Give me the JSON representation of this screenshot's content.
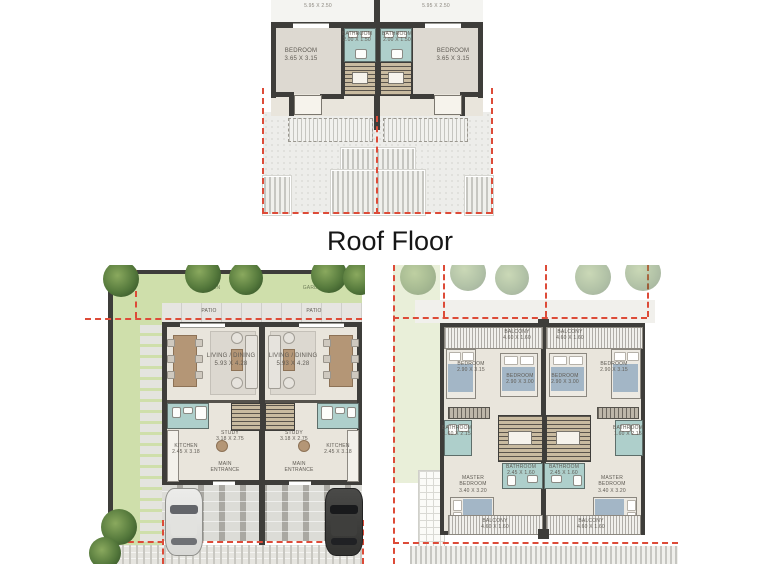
{
  "page": {
    "title": "Roof Floor"
  },
  "palette": {
    "wall": "#3e3d3a",
    "bathroom_fill": "#aecfcb",
    "garden_fill": "#cfdfab",
    "boundary_red": "#dd4b38",
    "floor_fill": "#e9e5dc"
  },
  "roof_floor_plan": {
    "terrace_dim": "5.95 X 2.50",
    "bedroom": {
      "name": "BEDROOM",
      "dim": "3.65 X 3.15"
    },
    "bathroom": {
      "name": "BATHROOM",
      "dim": "2.00 X 1.50"
    }
  },
  "ground_floor_plan": {
    "garden_label": "GARDEN",
    "patio_label": "PATIO",
    "living_dining": {
      "name": "LIVING / DINING",
      "dim": "5.93 X 4.28"
    },
    "study": {
      "name": "STUDY",
      "dim": "3.18 X 2.75"
    },
    "kitchen": {
      "name": "KITCHEN",
      "dim": "2.45 X 3.18"
    },
    "main_entrance": {
      "name": "MAIN ENTRANCE"
    }
  },
  "first_floor_plan": {
    "balcony_front": {
      "name": "BALCONY",
      "dim": "4.60 X 1.60"
    },
    "bedroom_side": {
      "name": "BEDROOM",
      "dim": "2.90 X 3.15"
    },
    "bedroom_center": {
      "name": "BEDROOM",
      "dim": "2.90 X 3.00"
    },
    "bathroom_side": {
      "name": "BATHROOM",
      "dim": "1.60 X 2.15"
    },
    "bathroom_center": {
      "name": "BATHROOM",
      "dim": "2.45 X 1.60"
    },
    "master_bedroom": {
      "name": "MASTER BEDROOM",
      "dim": "3.40 X 3.20"
    },
    "balcony_rear": {
      "name": "BALCONY",
      "dim": "4.60 X 1.60"
    }
  }
}
